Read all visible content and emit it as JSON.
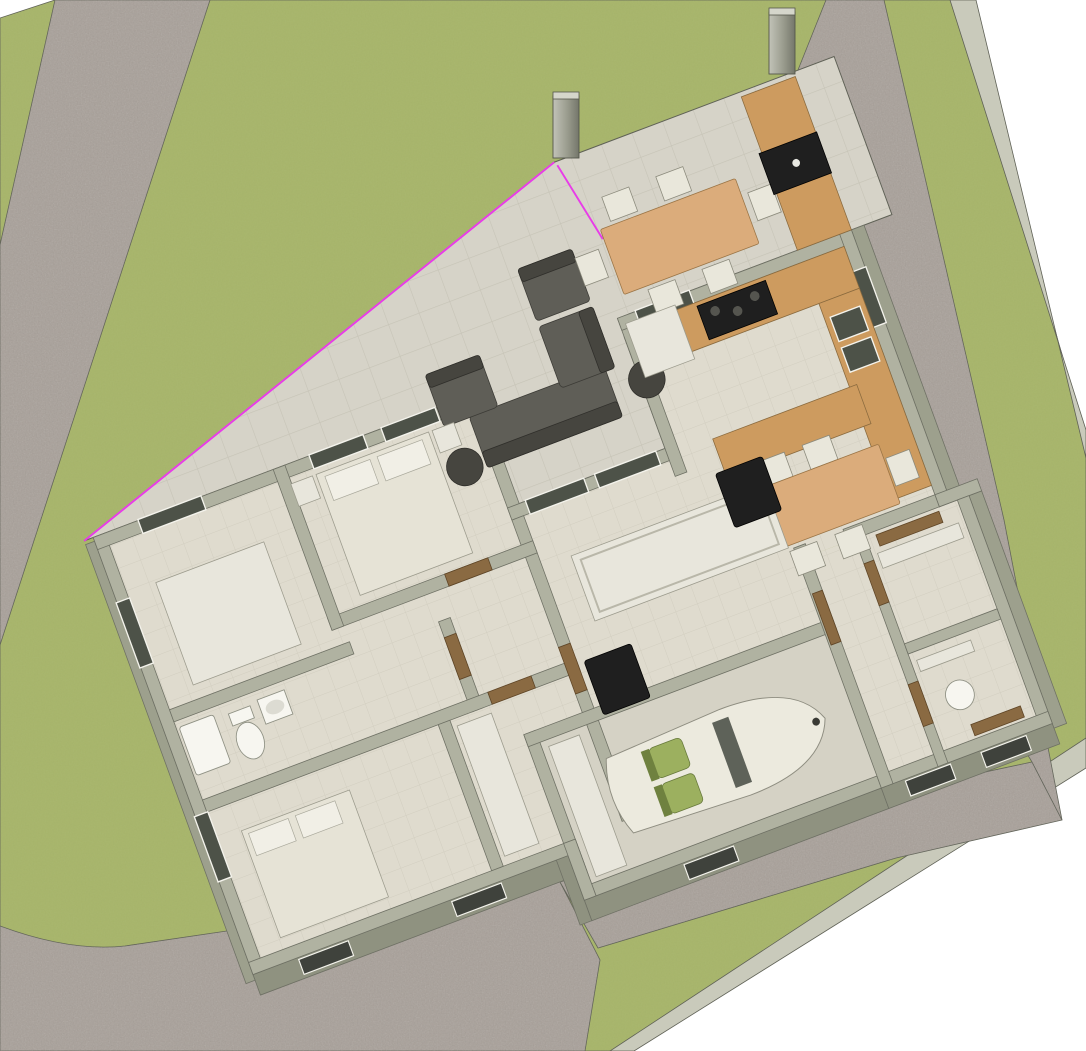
{
  "canvas": {
    "width": "1086",
    "height": "1051"
  },
  "view": {
    "type": "3d-model-viewport",
    "scene": "single-storey house plan on green lot"
  },
  "colors": {
    "bg": "#ffffff",
    "lawn": "#a7b56a",
    "road": "#a8a099",
    "curb": "#c9cabb",
    "edge": "#5f6156",
    "terrace": "#d6d3c8",
    "terraceline": "#c6c3b6",
    "floor": "#dfdbce",
    "floorline": "#d2cec0",
    "concrete": "#d5d2c5",
    "wall": "#b0b2a1",
    "wallside": "#8f9280",
    "wallside2": "#9da08d",
    "wallstroke": "#6e7064",
    "glass": "#4d5248",
    "vent": "#3f423c",
    "frame": "#f4f3ec",
    "door": "#8a6a42",
    "wood": "#cd9b5f",
    "tablewood": "#dbac7b",
    "chair": "#e9e7db",
    "sofa": "#5f5e57",
    "sofadark": "#46453f",
    "black": "#1f1f1f",
    "white": "#e8e6dc",
    "bed": "#e6e3d6",
    "pillow": "#f1efe6",
    "porcelain": "#f7f6f0",
    "car": "#eceade",
    "seat": "#9cb05f",
    "pink": "#e83ce8"
  },
  "scene_objects": [
    "lawn-lot",
    "road-west",
    "road-bottom",
    "road-southeast",
    "road-east",
    "curb-northeast",
    "curb-southeast",
    "terrace",
    "selection-highlight",
    "pillar-1",
    "pillar-2",
    "bbq-counter",
    "bbq-grill",
    "outdoor-dining-table",
    "outdoor-chairs",
    "outdoor-sofa-set",
    "side-tables",
    "kitchen-counter",
    "cooktop",
    "sink",
    "fridge-cabinet",
    "kitchen-island",
    "indoor-dining-table",
    "indoor-chairs",
    "family-table",
    "black-lounge-chairs",
    "bed-master",
    "bed-second",
    "study-table",
    "toilet",
    "pedestal-sink",
    "shower-tray",
    "round-basin",
    "closet-doors",
    "garage",
    "sports-car",
    "windows",
    "walls"
  ]
}
